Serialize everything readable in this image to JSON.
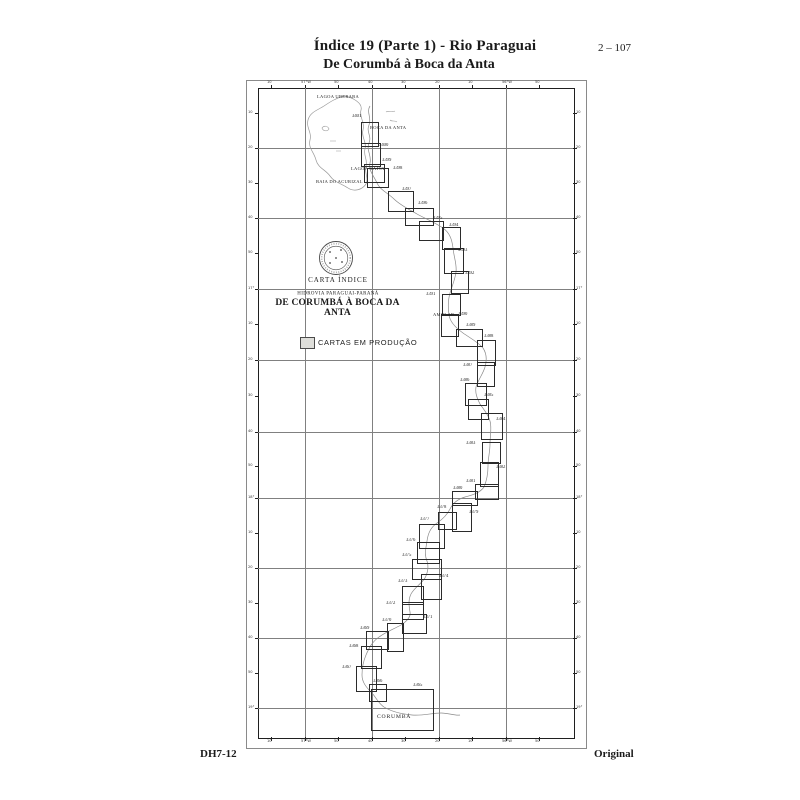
{
  "header": {
    "title1": "Índice 19 (Parte 1) - Rio Paraguai",
    "title2": "De Corumbá à Boca da Anta",
    "page_number": "2 – 107"
  },
  "footer": {
    "left": "DH7-12",
    "right": "Original"
  },
  "map": {
    "index_title": "CARTA ÍNDICE",
    "subtitle1": "HIDROVIA PARAGUAI-PARANÁ",
    "subtitle2": "DE CORUMBÁ À BOCA DA ANTA",
    "legend_label": "CARTAS EM PRODUÇÃO",
    "ink_color": "#2b2b2b",
    "water_color": "#8a8a8a",
    "places": [
      {
        "text": "LAGOA UBERABA",
        "x": 317,
        "y": 95,
        "size": "sm"
      },
      {
        "text": "BOCA DA ANTA",
        "x": 370,
        "y": 126,
        "size": "sm"
      },
      {
        "text": "LAGOA GAÍVA",
        "x": 351,
        "y": 167,
        "size": "sm"
      },
      {
        "text": "BAIA DO ACURIZAL",
        "x": 316,
        "y": 180,
        "size": "sm"
      },
      {
        "text": "AMOLAR",
        "x": 433,
        "y": 313,
        "size": "sm"
      },
      {
        "text": "CORUMBÁ",
        "x": 377,
        "y": 714,
        "size": "md"
      }
    ],
    "charts": [
      {
        "number": "3401",
        "box": [
          361,
          122,
          16,
          23
        ],
        "label": [
          352,
          114
        ]
      },
      {
        "number": "3400",
        "box": [
          361,
          143,
          18,
          22
        ],
        "label": [
          379,
          143
        ]
      },
      {
        "number": "3399",
        "box": [
          364,
          164,
          19,
          17
        ],
        "label": [
          382,
          158
        ]
      },
      {
        "number": "3398",
        "box": [
          367,
          168,
          20,
          18
        ],
        "label": [
          393,
          166
        ]
      },
      {
        "number": "3397",
        "box": [
          388,
          191,
          24,
          19
        ],
        "label": [
          402,
          187
        ]
      },
      {
        "number": "3396",
        "box": [
          405,
          208,
          27,
          16
        ],
        "label": [
          418,
          201
        ]
      },
      {
        "number": "3395",
        "box": [
          419,
          221,
          23,
          18
        ],
        "label": [
          433,
          216
        ]
      },
      {
        "number": "3394",
        "box": [
          442,
          227,
          17,
          21
        ],
        "label": [
          449,
          223
        ]
      },
      {
        "number": "3393",
        "box": [
          444,
          248,
          18,
          24
        ],
        "label": [
          458,
          248
        ]
      },
      {
        "number": "3392",
        "box": [
          451,
          271,
          16,
          21
        ],
        "label": [
          465,
          271
        ]
      },
      {
        "number": "3391",
        "box": [
          442,
          294,
          17,
          20
        ],
        "label": [
          426,
          292
        ]
      },
      {
        "number": "3390",
        "box": [
          441,
          314,
          16,
          21
        ],
        "label": [
          458,
          312
        ]
      },
      {
        "number": "3389",
        "box": [
          456,
          329,
          25,
          16
        ],
        "label": [
          466,
          323
        ]
      },
      {
        "number": "3388",
        "box": [
          477,
          340,
          17,
          24
        ],
        "label": [
          484,
          334
        ]
      },
      {
        "number": "3387",
        "box": [
          477,
          362,
          16,
          23
        ],
        "label": [
          463,
          363
        ]
      },
      {
        "number": "3386",
        "box": [
          465,
          383,
          20,
          21
        ],
        "label": [
          460,
          378
        ]
      },
      {
        "number": "3385",
        "box": [
          468,
          399,
          19,
          19
        ],
        "label": [
          484,
          393
        ]
      },
      {
        "number": "3384",
        "box": [
          481,
          413,
          20,
          25
        ],
        "label": [
          496,
          417
        ]
      },
      {
        "number": "3383",
        "box": [
          482,
          442,
          17,
          20
        ],
        "label": [
          466,
          441
        ]
      },
      {
        "number": "3382",
        "box": [
          480,
          462,
          17,
          23
        ],
        "label": [
          496,
          465
        ]
      },
      {
        "number": "3381",
        "box": [
          475,
          484,
          22,
          14
        ],
        "label": [
          466,
          479
        ]
      },
      {
        "number": "3380",
        "box": [
          452,
          491,
          24,
          13
        ],
        "label": [
          453,
          486
        ]
      },
      {
        "number": "3379",
        "box": [
          452,
          503,
          18,
          27
        ],
        "label": [
          469,
          510
        ]
      },
      {
        "number": "3378",
        "box": [
          438,
          512,
          17,
          16
        ],
        "label": [
          437,
          505
        ]
      },
      {
        "number": "3377",
        "box": [
          419,
          524,
          24,
          23
        ],
        "label": [
          420,
          517
        ]
      },
      {
        "number": "3376",
        "box": [
          417,
          542,
          21,
          20
        ],
        "label": [
          406,
          538
        ]
      },
      {
        "number": "3375",
        "box": [
          412,
          559,
          28,
          19
        ],
        "label": [
          402,
          553
        ]
      },
      {
        "number": "3374",
        "box": [
          421,
          574,
          19,
          24
        ],
        "label": [
          439,
          574
        ]
      },
      {
        "number": "3373",
        "box": [
          402,
          586,
          20,
          17
        ],
        "label": [
          398,
          579
        ]
      },
      {
        "number": "3372",
        "box": [
          402,
          602,
          20,
          16
        ],
        "label": [
          386,
          601
        ]
      },
      {
        "number": "3371",
        "box": [
          402,
          614,
          23,
          18
        ],
        "label": [
          423,
          615
        ]
      },
      {
        "number": "3370",
        "box": [
          387,
          623,
          15,
          27
        ],
        "label": [
          382,
          618
        ]
      },
      {
        "number": "3369",
        "box": [
          366,
          631,
          21,
          17
        ],
        "label": [
          360,
          626
        ]
      },
      {
        "number": "3368",
        "box": [
          361,
          646,
          19,
          21
        ],
        "label": [
          349,
          644
        ]
      },
      {
        "number": "3367",
        "box": [
          356,
          666,
          19,
          24
        ],
        "label": [
          342,
          665
        ]
      },
      {
        "number": "3366",
        "box": [
          369,
          684,
          16,
          16
        ],
        "label": [
          373,
          679
        ]
      },
      {
        "number": "3365",
        "box": [
          371,
          689,
          61,
          40
        ],
        "label": [
          413,
          683
        ]
      }
    ],
    "grid": {
      "x": [
        305,
        372,
        439,
        506
      ],
      "y": [
        148,
        218,
        289,
        360,
        432,
        498,
        568,
        638,
        708
      ]
    },
    "ticks": {
      "lon": [
        {
          "x": 271,
          "label": "10"
        },
        {
          "x": 305,
          "label": "57°W"
        },
        {
          "x": 338,
          "label": "50"
        },
        {
          "x": 372,
          "label": "40"
        },
        {
          "x": 405,
          "label": "30"
        },
        {
          "x": 439,
          "label": "20"
        },
        {
          "x": 472,
          "label": "10"
        },
        {
          "x": 506,
          "label": "56°W"
        },
        {
          "x": 539,
          "label": "50"
        }
      ],
      "lat": [
        {
          "y": 113,
          "label": "10"
        },
        {
          "y": 148,
          "label": "20"
        },
        {
          "y": 183,
          "label": "30"
        },
        {
          "y": 218,
          "label": "40"
        },
        {
          "y": 253,
          "label": "50"
        },
        {
          "y": 289,
          "label": "17°"
        },
        {
          "y": 324,
          "label": "10"
        },
        {
          "y": 360,
          "label": "20"
        },
        {
          "y": 396,
          "label": "30"
        },
        {
          "y": 432,
          "label": "40"
        },
        {
          "y": 466,
          "label": "50"
        },
        {
          "y": 498,
          "label": "18°"
        },
        {
          "y": 533,
          "label": "10"
        },
        {
          "y": 568,
          "label": "20"
        },
        {
          "y": 603,
          "label": "30"
        },
        {
          "y": 638,
          "label": "40"
        },
        {
          "y": 673,
          "label": "50"
        },
        {
          "y": 708,
          "label": "19°"
        }
      ]
    }
  }
}
